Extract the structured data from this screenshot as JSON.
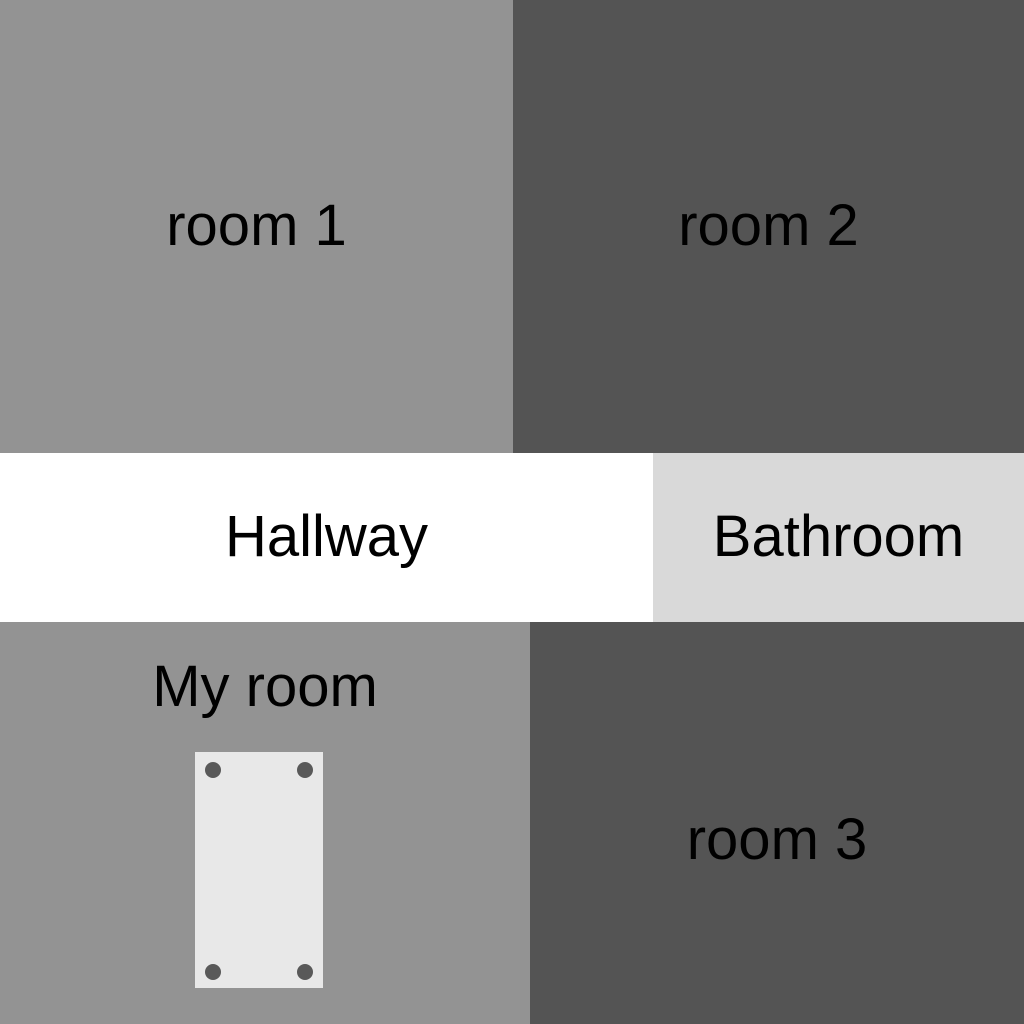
{
  "rooms": {
    "room1": {
      "label": "room 1",
      "color": "#939393"
    },
    "room2": {
      "label": "room 2",
      "color": "#545454"
    },
    "hallway": {
      "label": "Hallway",
      "color": "#ffffff"
    },
    "bathroom": {
      "label": "Bathroom",
      "color": "#d9d9d9"
    },
    "myroom": {
      "label": "My room",
      "color": "#939393"
    },
    "room3": {
      "label": "room 3",
      "color": "#545454"
    }
  },
  "furniture": {
    "bed": {
      "color": "#e8e8e8",
      "post_color": "#595959",
      "post_count": 4
    }
  },
  "text_color": "#000000"
}
